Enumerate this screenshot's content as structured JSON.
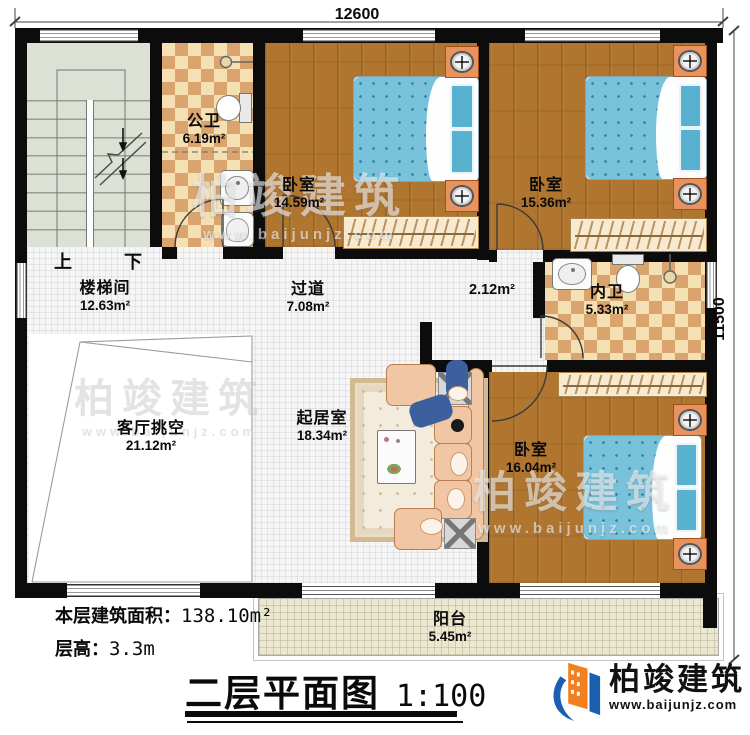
{
  "dimensions": {
    "top": "12600",
    "right": "11500"
  },
  "rooms": {
    "stairwell": {
      "name": "楼梯间",
      "area": "12.63m²"
    },
    "public_bath": {
      "name": "公卫",
      "area": "6.19m²"
    },
    "bedroom_top": {
      "name": "卧室",
      "area": "14.59m²"
    },
    "bedroom_right": {
      "name": "卧室",
      "area": "15.36m²"
    },
    "corridor": {
      "name": "过道",
      "area": "7.08m²"
    },
    "vestibule": {
      "area": "2.12m²"
    },
    "inner_bath": {
      "name": "内卫",
      "area": "5.33m²"
    },
    "living_void": {
      "name": "客厅挑空",
      "area": "21.12m²"
    },
    "living": {
      "name": "起居室",
      "area": "18.34m²"
    },
    "bedroom_bottom": {
      "name": "卧室",
      "area": "16.04m²"
    },
    "balcony": {
      "name": "阳台",
      "area": "5.45m²"
    }
  },
  "stairs": {
    "up": "上",
    "down": "下"
  },
  "notes": {
    "area_label": "本层建筑面积：",
    "area_value": "138.10m²",
    "height_label": "层高：",
    "height_value": "3.3m"
  },
  "title": {
    "text": "二层平面图",
    "scale": "1:100"
  },
  "logo": {
    "name": "柏竣建筑",
    "url": "www.baijunjz.com"
  },
  "watermark": {
    "name": "柏竣建筑",
    "url": "www.baijunjz.com"
  },
  "colors": {
    "wall": "#0c0c0c",
    "wood_floor": "#b0752f",
    "tile_light": "#f4e0b2",
    "tile_dark": "#d9a46e",
    "bed_blue": "#79c2dc",
    "sofa_peach": "#f1c6a4",
    "logo_orange": "#f08020",
    "logo_blue": "#1b5fb0"
  }
}
